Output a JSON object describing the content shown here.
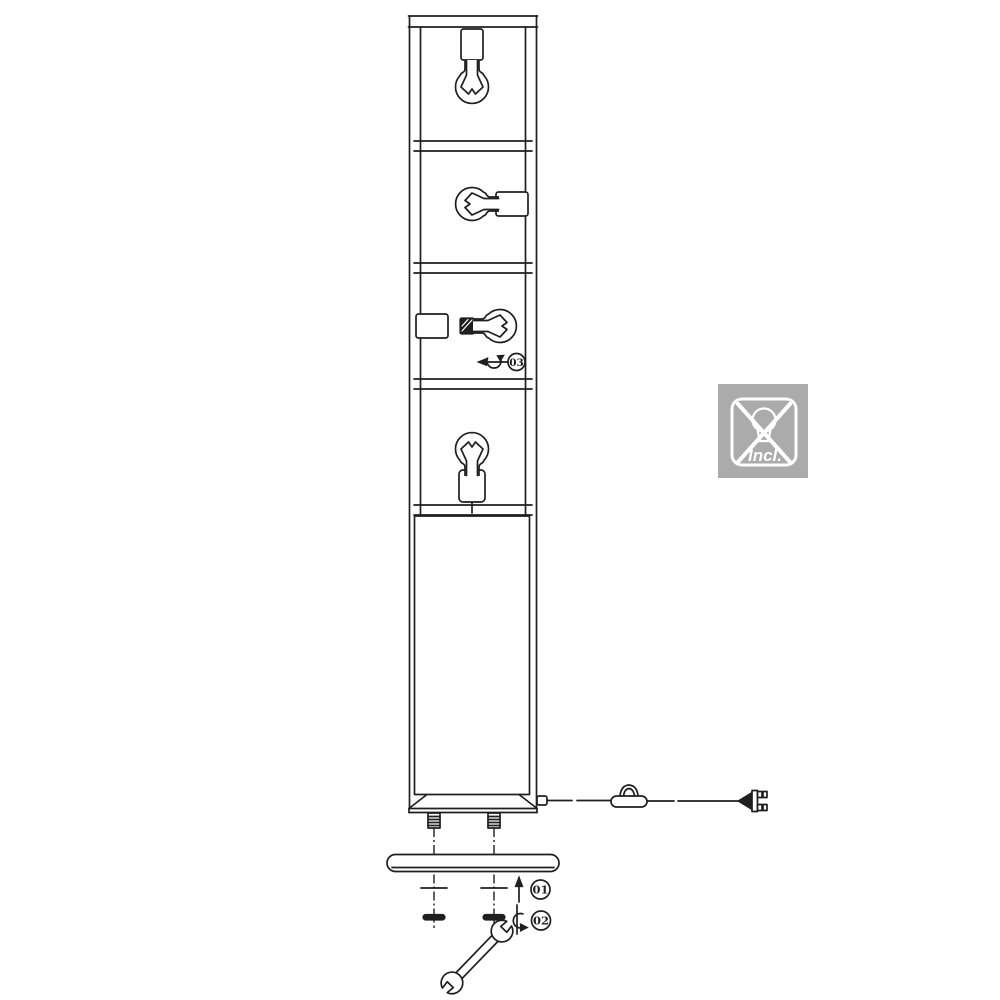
{
  "colors": {
    "line": "#1f1f1f",
    "background": "#ffffff",
    "badge_bg": "#ababab",
    "badge_fg": "#ffffff"
  },
  "steps": {
    "s01": "01",
    "s02": "02",
    "s03": "03"
  },
  "badge": {
    "label": "Incl.",
    "icon": "crossed-out-bulb-icon"
  },
  "icons": {
    "bulbs": "incandescent-bulb-icon",
    "switch": "inline-cord-switch-icon",
    "plug": "power-plug-icon",
    "arrow": "arrow-up-icon",
    "rotate_vertical": "rotate-screw-icon",
    "rotate_horizontal": "rotate-bulb-icon",
    "tool": "wrench-icon"
  }
}
